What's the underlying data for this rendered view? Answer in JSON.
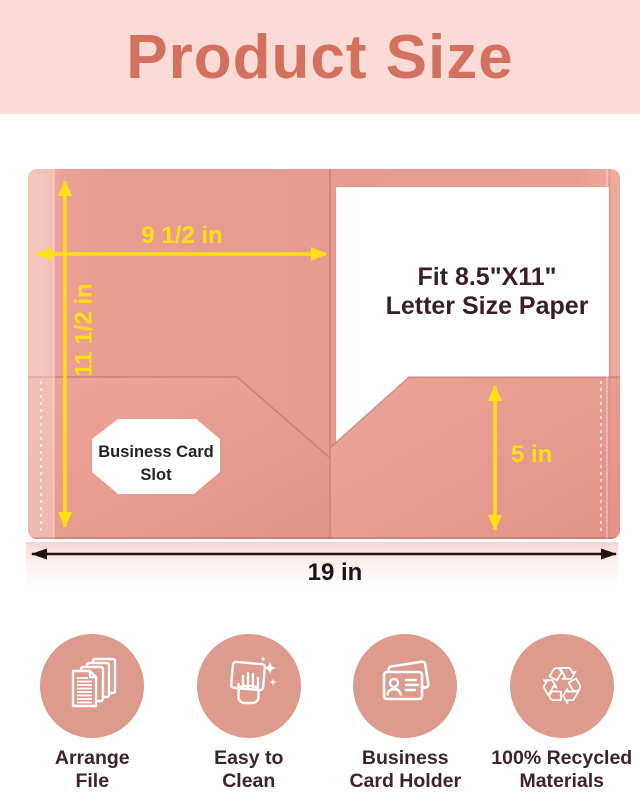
{
  "header": {
    "title": "Product Size"
  },
  "diagram": {
    "width_label": "9 1/2 in",
    "height_label": "11 1/2 in",
    "pocket_depth_label": "5 in",
    "total_width_label": "19 in",
    "paper_line1": "Fit 8.5\"X11\"",
    "paper_line2": "Letter Size Paper",
    "card_slot_line1": "Business Card",
    "card_slot_line2": "Slot"
  },
  "features": [
    {
      "icon": "documents-stack-icon",
      "line1": "Arrange",
      "line2": "File"
    },
    {
      "icon": "cleaning-hand-icon",
      "line1": "Easy to",
      "line2": "Clean"
    },
    {
      "icon": "business-card-icon",
      "line1": "Business",
      "line2": "Card Holder"
    },
    {
      "icon": "recycle-icon",
      "line1": "100% Recycled",
      "line2": "Materials"
    }
  ],
  "colors": {
    "header_bg": "#fbdbd5",
    "title_text": "#d4705f",
    "folder_pink": "#e89a8f",
    "dimension_yellow": "#ffe013",
    "total_width_arrow": "#1e1412",
    "icon_circle": "#dc9b8d",
    "feature_label": "#3e2427",
    "paper_text": "#3a2023"
  }
}
